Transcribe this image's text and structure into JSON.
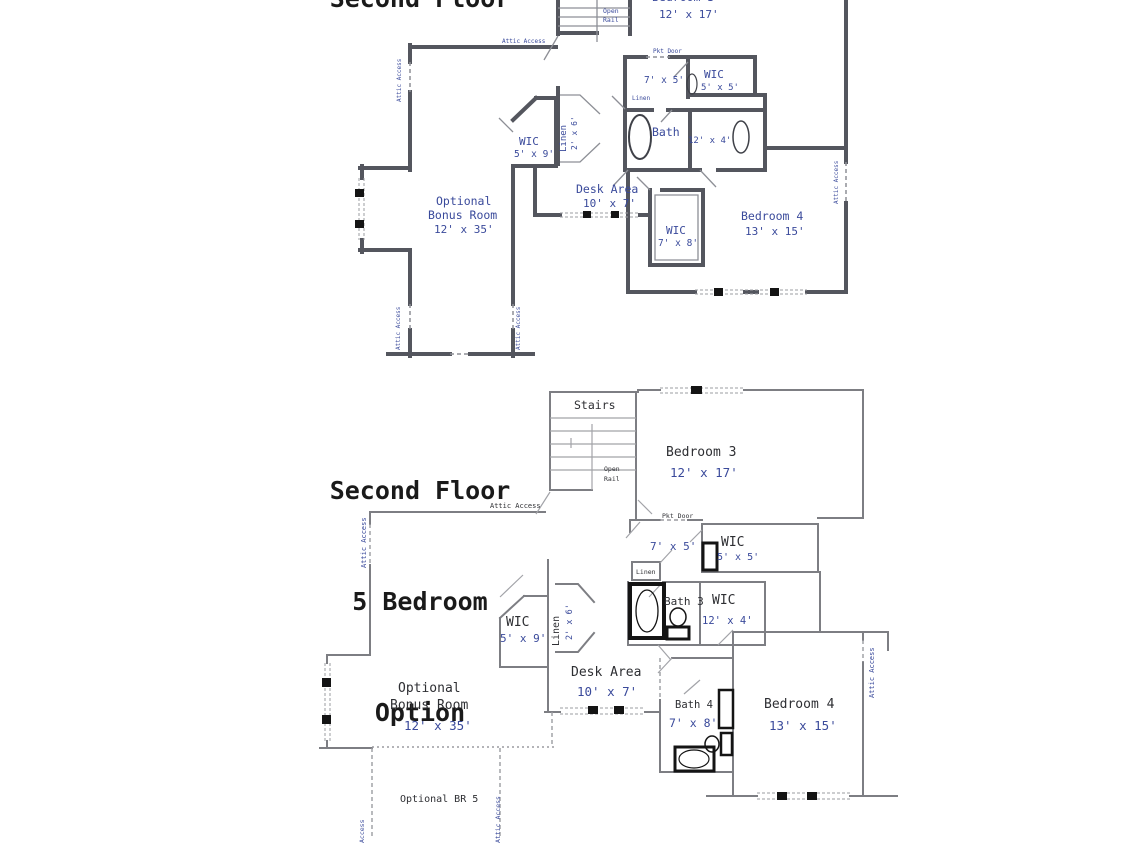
{
  "canvas": {
    "width": 1125,
    "height": 844,
    "background": "#ffffff"
  },
  "colors": {
    "dimension_blue": "#3a4a9b",
    "room_name_dark": "#2e2f33",
    "wall_dark": "#54565e",
    "wall_gray": "#7d7e83",
    "fixture_black": "#141414",
    "title_black": "#1a1a1a"
  },
  "plan_top": {
    "title": "Second Floor",
    "labels": {
      "bedroom3_name": "Bedroom 3",
      "bedroom3_dim": "12' x 17'",
      "open_rail_1": "Open",
      "open_rail_2": "Rail",
      "attic_access_top": "Attic Access",
      "attic_access_left": "Attic Access",
      "attic_access_right": "Attic Access",
      "attic_access_bottom_left": "Attic Access",
      "attic_access_bottom_right": "Attic Access",
      "pkt_door": "Pkt Door",
      "hall_dim": "7' x 5'",
      "wic_5x5_name": "WIC",
      "wic_5x5_dim": "5' x 5'",
      "linen_small": "Linen",
      "wic_5x9_name": "WIC",
      "wic_5x9_dim": "5' x 9'",
      "linen_closet_name": "Linen",
      "linen_closet_dim": "2' x 6'",
      "bath_name": "Bath",
      "closet_dim": "12' x 4'",
      "desk_name": "Desk Area",
      "desk_dim": "10' x 7'",
      "wic_7x8_name": "WIC",
      "wic_7x8_dim": "7' x 8'",
      "bedroom4_name": "Bedroom 4",
      "bedroom4_dim": "13' x 15'",
      "bonus_line1": "Optional",
      "bonus_line2": "Bonus Room",
      "bonus_dim": "12' x 35'"
    }
  },
  "plan_bottom": {
    "title_line1": "Second Floor",
    "title_line2": "5 Bedroom",
    "title_line3": "Option",
    "labels": {
      "stairs": "Stairs",
      "open_rail_1": "Open",
      "open_rail_2": "Rail",
      "bedroom3_name": "Bedroom 3",
      "bedroom3_dim": "12' x 17'",
      "attic_access_top": "Attic Access",
      "attic_access_left": "Attic Access",
      "attic_access_right": "Attic Access",
      "attic_access_bottom_right": "Attic Access",
      "access_bottom_left": "Access",
      "pkt_door": "Pkt Door",
      "hall_dim": "7' x 5'",
      "wic_5x5_name": "WIC",
      "wic_5x5_dim": "5' x 5'",
      "linen_small": "Linen",
      "bath3_name": "Bath 3",
      "wic_12x4_name": "WIC",
      "wic_12x4_dim": "12' x 4'",
      "wic_5x9_name": "WIC",
      "wic_5x9_dim": "5' x 9'",
      "linen_closet_name": "Linen",
      "linen_closet_dim": "2' x 6'",
      "desk_name": "Desk Area",
      "desk_dim": "10' x 7'",
      "bath4_name": "Bath 4",
      "bath4_dim": "7' x 8'",
      "bedroom4_name": "Bedroom 4",
      "bedroom4_dim": "13' x 15'",
      "bonus_line1": "Optional",
      "bonus_line2": "Bonus Room",
      "bonus_dim": "12' x 35'",
      "optional_br5": "Optional BR 5"
    }
  }
}
